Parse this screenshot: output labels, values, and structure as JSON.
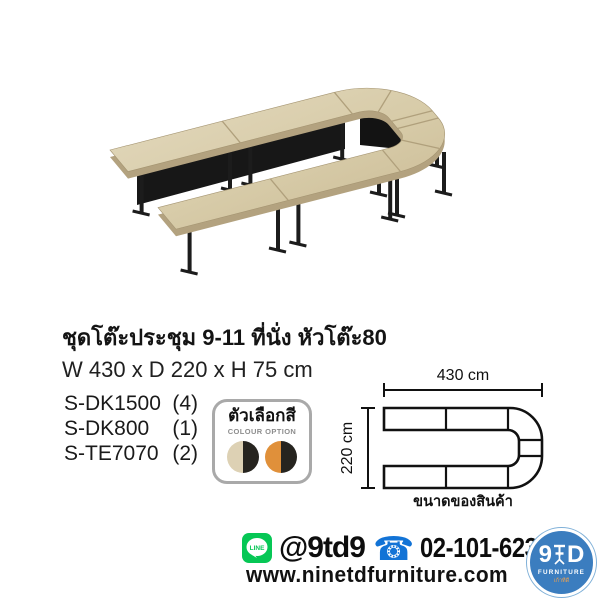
{
  "product": {
    "title": "ชุดโต๊ะประชุม 9-11 ที่นั่ง หัวโต๊ะ80",
    "dimensions": "W 430 x D 220 x H 75 cm",
    "items": [
      {
        "code": "S-DK1500",
        "qty": "(4)"
      },
      {
        "code": "S-DK800",
        "qty": "(1)"
      },
      {
        "code": "S-TE7070",
        "qty": "(2)"
      }
    ]
  },
  "colour_option": {
    "label_th": "ตัวเลือกสี",
    "label_en": "COLOUR OPTION",
    "swatches": [
      {
        "name": "oak-black",
        "left": "#ddd1b4",
        "right": "#26241f"
      },
      {
        "name": "orange-black",
        "left": "#e0903a",
        "right": "#26241f"
      }
    ]
  },
  "diagram": {
    "width_label": "430 cm",
    "depth_label": "220 cm",
    "caption": "ขนาดของสินค้า"
  },
  "footer": {
    "line_badge": "LINE",
    "line_id": "@9td9",
    "phone_glyph": "☎",
    "phone": "02-101-6232",
    "website": "www.ninetdfurniture.com",
    "logo": {
      "left": "9",
      "right": "D",
      "sub": "FURNITURE",
      "sub_th": "เก้าทีดี"
    }
  },
  "colors": {
    "wood_light": "#e3d8bb",
    "wood_dark": "#cdbd97",
    "wood_edge": "#b3a27f",
    "leg_black": "#1c1c1c",
    "line_green": "#06c755",
    "phone_blue": "#1273d6",
    "logo_blue": "#3b7dbf"
  }
}
